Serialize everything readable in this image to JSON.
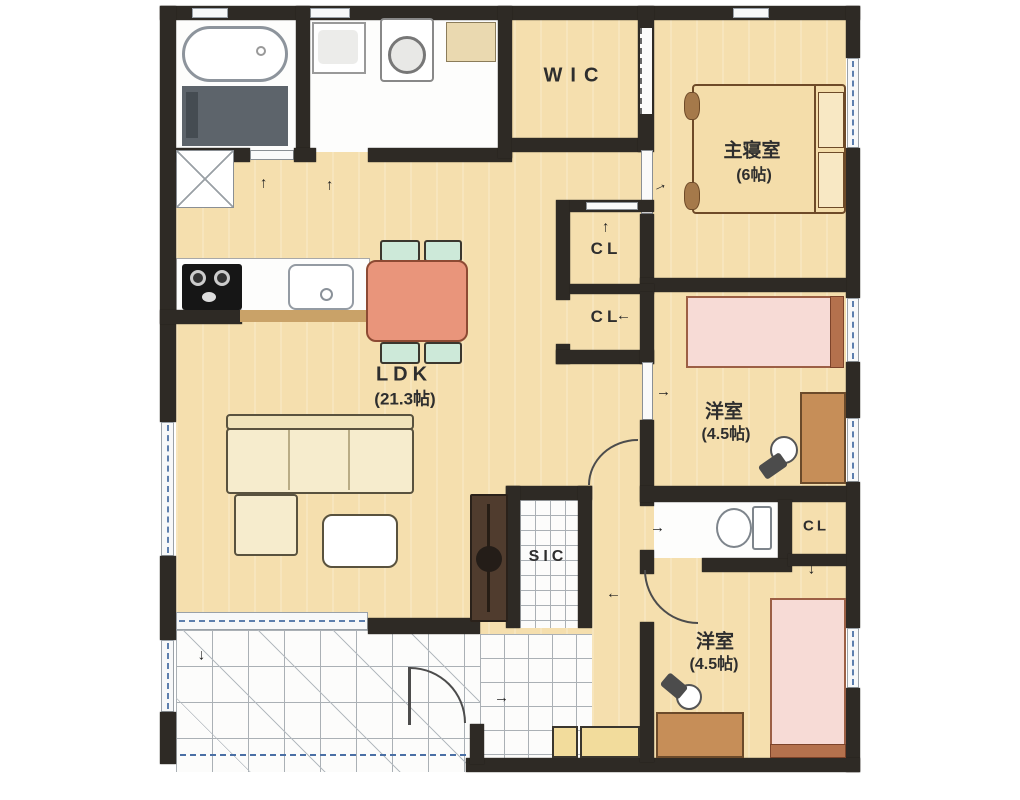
{
  "floorplan": {
    "rooms": {
      "wic": {
        "label": "WIC"
      },
      "master_bedroom": {
        "name": "主寝室",
        "size": "(6帖)"
      },
      "closet_1": {
        "label": "CL"
      },
      "closet_2": {
        "label": "CL"
      },
      "closet_3": {
        "label": "CL"
      },
      "ldk": {
        "name": "LDK",
        "size": "(21.3帖)"
      },
      "western_room_middle": {
        "name": "洋室",
        "size": "(4.5帖)"
      },
      "western_room_bottom": {
        "name": "洋室",
        "size": "(4.5帖)"
      },
      "sic": {
        "label": "SIC"
      }
    },
    "colors": {
      "wall": "#2e2a25",
      "floor_wood": "#f5dfae",
      "tile_white": "#fcfcfb",
      "bed_pink": "#f7dbd6",
      "bed_frame_brown": "#b4714d",
      "dining_table": "#e9957b",
      "chair_mint": "#cde9d9",
      "sofa_cream": "#f6eccd",
      "desk_wood": "#c68e58",
      "tv_board": "#503c2e",
      "bath_floor": "#5d646b",
      "window_blue": "#5d7fae",
      "step_yellow": "#f2dc9c"
    }
  }
}
